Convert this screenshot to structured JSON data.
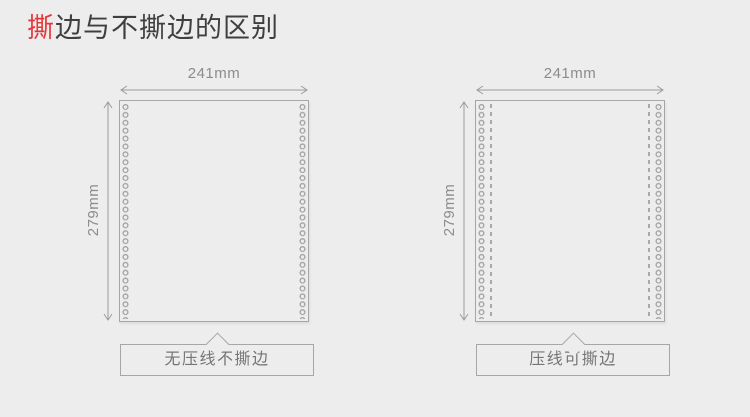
{
  "page": {
    "background": "#ededed"
  },
  "title": {
    "highlight": "撕",
    "rest": "边与不撕边的区别",
    "highlight_color": "#e4393c",
    "text_color": "#3f3f3f"
  },
  "colors": {
    "accent_red": "#e4393c",
    "line_gray": "#a6a6a6",
    "dimension_text": "#8c8c8c",
    "caption_text": "#757575"
  },
  "diagrams": [
    {
      "id": "left",
      "width_label": "241mm",
      "height_label": "279mm",
      "caption": "无压线不撕边",
      "has_tear_line": false
    },
    {
      "id": "right",
      "width_label": "241mm",
      "height_label": "279mm",
      "caption": "压线可撕边",
      "has_tear_line": true
    }
  ]
}
